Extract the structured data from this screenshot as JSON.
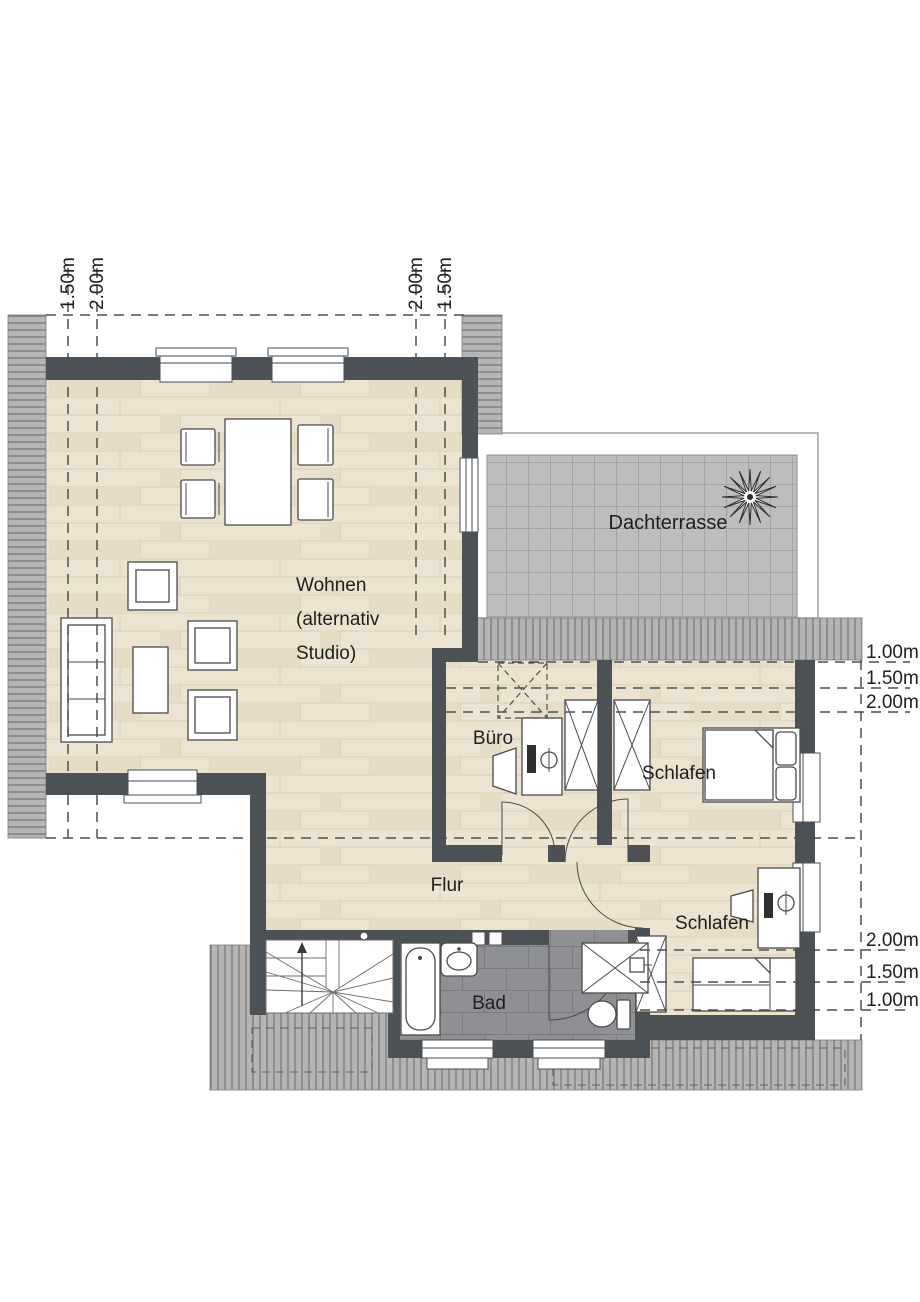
{
  "rooms": {
    "wohnen": {
      "line1": "Wohnen",
      "line2": "(alternativ",
      "line3": "Studio)"
    },
    "dachterrasse": {
      "label": "Dachterrasse"
    },
    "buero": {
      "label": "Büro"
    },
    "schlafen_1": {
      "label": "Schlafen"
    },
    "schlafen_2": {
      "label": "Schlafen"
    },
    "flur": {
      "label": "Flur"
    },
    "bad": {
      "label": "Bad"
    }
  },
  "dimensions": {
    "top_left": [
      "1.50m",
      "2.00m"
    ],
    "top_middle": [
      "2.00m",
      "1.50m"
    ],
    "right_upper": [
      "1.00m",
      "1.50m",
      "2.00m"
    ],
    "right_lower": [
      "2.00m",
      "1.50m",
      "1.00m"
    ]
  },
  "colors": {
    "wall": "#4c5156",
    "wood_floor": "#ece3d0",
    "terrace_tile": "#bdbdbd",
    "bath_tile": "#8f9093",
    "roof_hatch": "#b5b5b5"
  }
}
